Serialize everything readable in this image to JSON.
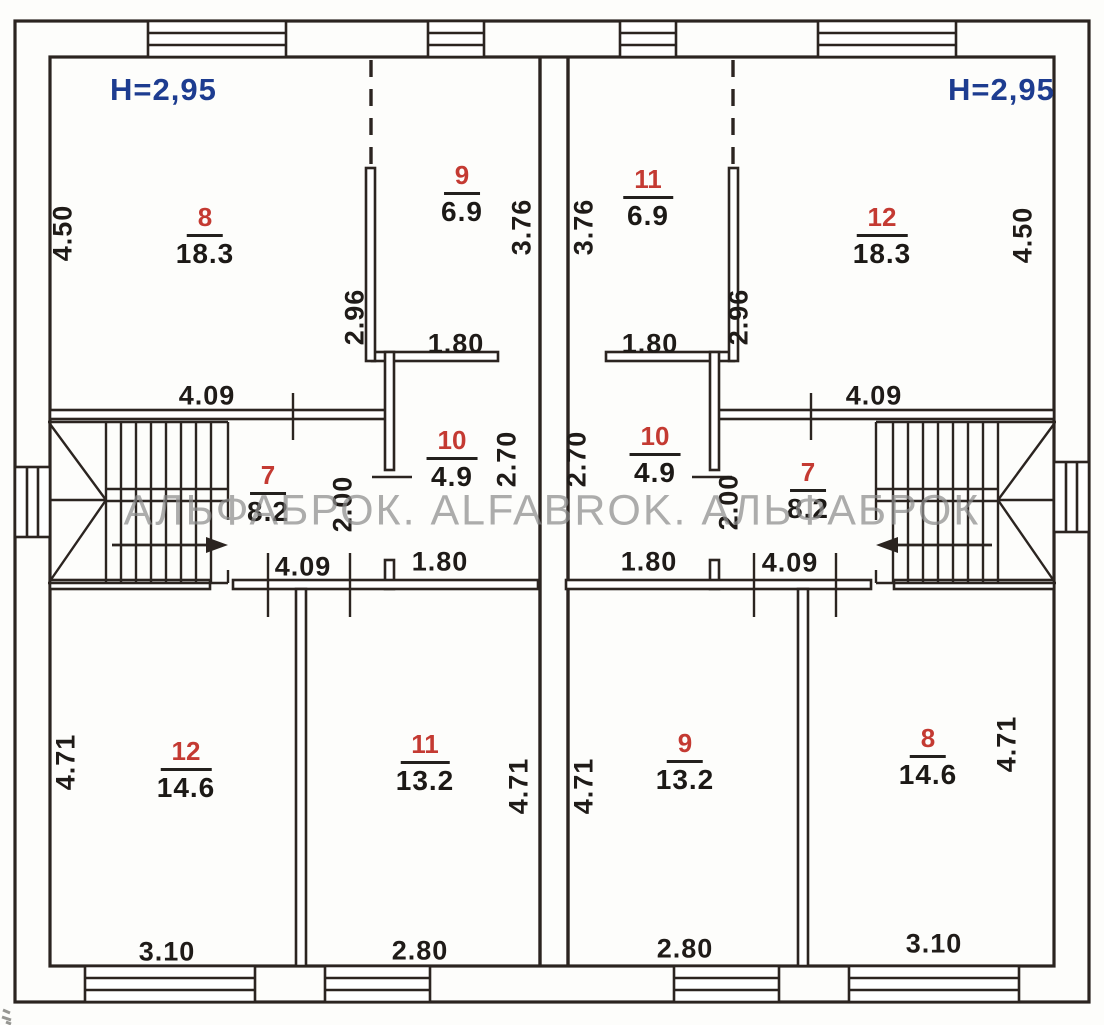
{
  "watermark_text": "АЛЬФАБРОК. ALFABROK. АЛЬФАБРОК",
  "units": {
    "left": {
      "height_note": "H=2,95",
      "rooms": {
        "r8": {
          "number": "8",
          "area": "18.3"
        },
        "r9": {
          "number": "9",
          "area": "6.9"
        },
        "r7": {
          "number": "7",
          "area": "8.2"
        },
        "r10": {
          "number": "10",
          "area": "4.9"
        },
        "r12": {
          "number": "12",
          "area": "14.6"
        },
        "r11": {
          "number": "11",
          "area": "13.2"
        }
      },
      "dimensions": {
        "room8_height": "4.50",
        "room8_width": "4.09",
        "partition_89": "2.96",
        "room9_height": "3.76",
        "room9_width": "1.80",
        "room7_width": "2.00",
        "room7_span": "4.09",
        "room10_height": "2.70",
        "room10_width": "1.80",
        "room12_height": "4.71",
        "room12_width": "3.10",
        "room11_height": "4.71",
        "room11_width": "2.80"
      }
    },
    "right": {
      "height_note": "H=2,95",
      "rooms": {
        "r11": {
          "number": "11",
          "area": "6.9"
        },
        "r12": {
          "number": "12",
          "area": "18.3"
        },
        "r10": {
          "number": "10",
          "area": "4.9"
        },
        "r7": {
          "number": "7",
          "area": "8.2"
        },
        "r9": {
          "number": "9",
          "area": "13.2"
        },
        "r8": {
          "number": "8",
          "area": "14.6"
        }
      },
      "dimensions": {
        "room11_height": "3.76",
        "room11_width": "1.80",
        "partition_1112": "2.96",
        "room12_height": "4.50",
        "room12_width": "4.09",
        "room10_height": "2.70",
        "room10_width": "1.80",
        "room7_width": "2.00",
        "room7_span": "4.09",
        "room9_height": "4.71",
        "room9_width": "2.80",
        "room8_height": "4.71",
        "room8_width": "3.10"
      }
    }
  }
}
